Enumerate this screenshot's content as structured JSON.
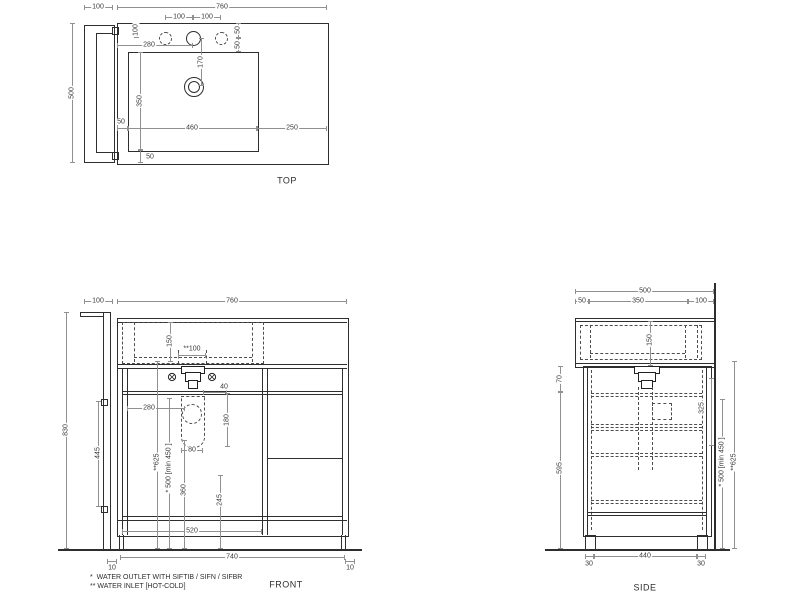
{
  "drawing_title": "vanity washbasin unit technical drawing",
  "colors": {
    "object_line": "#2e2e2e",
    "hidden_line": "#4d4d4d",
    "dimension_line": "#909090",
    "text": "#3a3a3a",
    "background": "#ffffff"
  },
  "views": {
    "top": {
      "label": "TOP",
      "dims": {
        "side_panel_width": "100",
        "overall_width": "760",
        "tap_hole_left_spacing": "100",
        "tap_hole_right_spacing": "100",
        "tap_hole_setback": "100",
        "tap_hole_from_left": "280",
        "right_hole_offset_a": "50",
        "right_hole_offset_b": "50",
        "drain_from_tap": "170",
        "basin_depth": "350",
        "overall_depth": "500",
        "basin_gap_left": "50",
        "basin_width": "460",
        "counter_right": "250",
        "basin_gap_front": "50"
      }
    },
    "front": {
      "label": "FRONT",
      "dims": {
        "side_panel_width": "100",
        "overall_width": "760",
        "basin_inner_height": "150",
        "water_inlet_spacing": "**100",
        "drain_offset": "40",
        "trap_from_left": "280",
        "trap_height": "180",
        "trap_width": "80",
        "water_inlet_height": "**625",
        "water_outlet_height": "* 500 [min 450 ]",
        "pipe_height_a": "360",
        "pipe_height_b": "245",
        "hinge_spacing": "445",
        "overall_height": "830",
        "plinth_width": "520",
        "feet_spacing": "740",
        "foot_inset_left": "10",
        "foot_inset_right": "10"
      }
    },
    "side": {
      "label": "SIDE",
      "dims": {
        "overall_depth": "500",
        "front_edge": "50",
        "basin_depth": "350",
        "back_gap": "100",
        "basin_inner_height": "150",
        "worktop_drop": "70",
        "cabinet_height": "595",
        "outlet_depth": "325",
        "water_outlet_height": "* 500 [min 450 ]",
        "water_inlet_height": "**625",
        "foot_inset_front": "30",
        "feet_spacing": "440",
        "foot_inset_back": "30"
      }
    }
  },
  "notes": {
    "line1": "*  WATER OUTLET WITH SIFTIB / SIFN / SIFBR",
    "line2": "** WATER INLET [HOT-COLD]"
  }
}
